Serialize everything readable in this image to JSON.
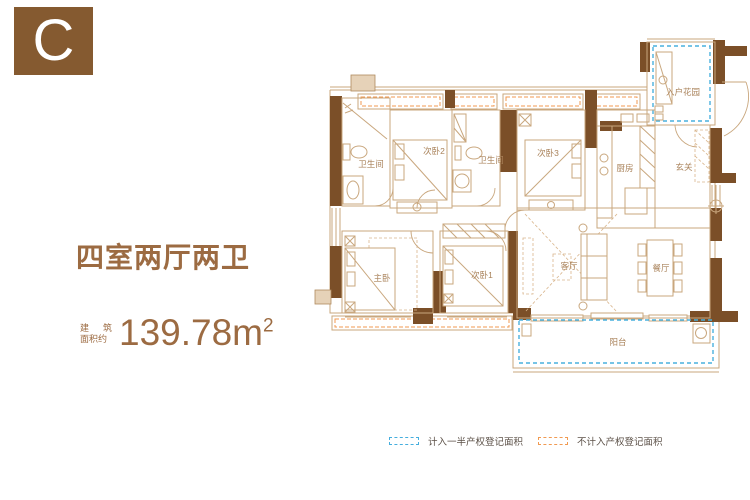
{
  "badge": {
    "letter": "C"
  },
  "summary": {
    "title": "四室两厅两卫",
    "area_label_line1_a": "建",
    "area_label_line1_b": "筑",
    "area_label_line2": "面积约",
    "area_value": "139.78",
    "area_unit": "m",
    "area_exponent": "2"
  },
  "floorplan": {
    "rooms": [
      {
        "name": "bathroom-1",
        "label": "卫生间"
      },
      {
        "name": "bedroom-2",
        "label": "次卧2"
      },
      {
        "name": "bathroom-2",
        "label": "卫生间"
      },
      {
        "name": "bedroom-3",
        "label": "次卧3"
      },
      {
        "name": "kitchen",
        "label": "厨房"
      },
      {
        "name": "foyer",
        "label": "玄关"
      },
      {
        "name": "entry-garden",
        "label": "入户花园"
      },
      {
        "name": "master-bedroom",
        "label": "主卧"
      },
      {
        "name": "bedroom-1",
        "label": "次卧1"
      },
      {
        "name": "living-room",
        "label": "客厅"
      },
      {
        "name": "dining-room",
        "label": "餐厅"
      },
      {
        "name": "balcony",
        "label": "阳台"
      }
    ]
  },
  "legend": {
    "half_area_label": "计入一半产权登记面积",
    "excluded_area_label": "不计入产权登记面积"
  },
  "colors": {
    "wall": "#7b4f28",
    "badge": "#855a30",
    "accent_text": "#9c6b42",
    "furniture_line": "#c9a77e",
    "half_dashed": "#45aede",
    "excluded_dashed": "#f19a51"
  }
}
